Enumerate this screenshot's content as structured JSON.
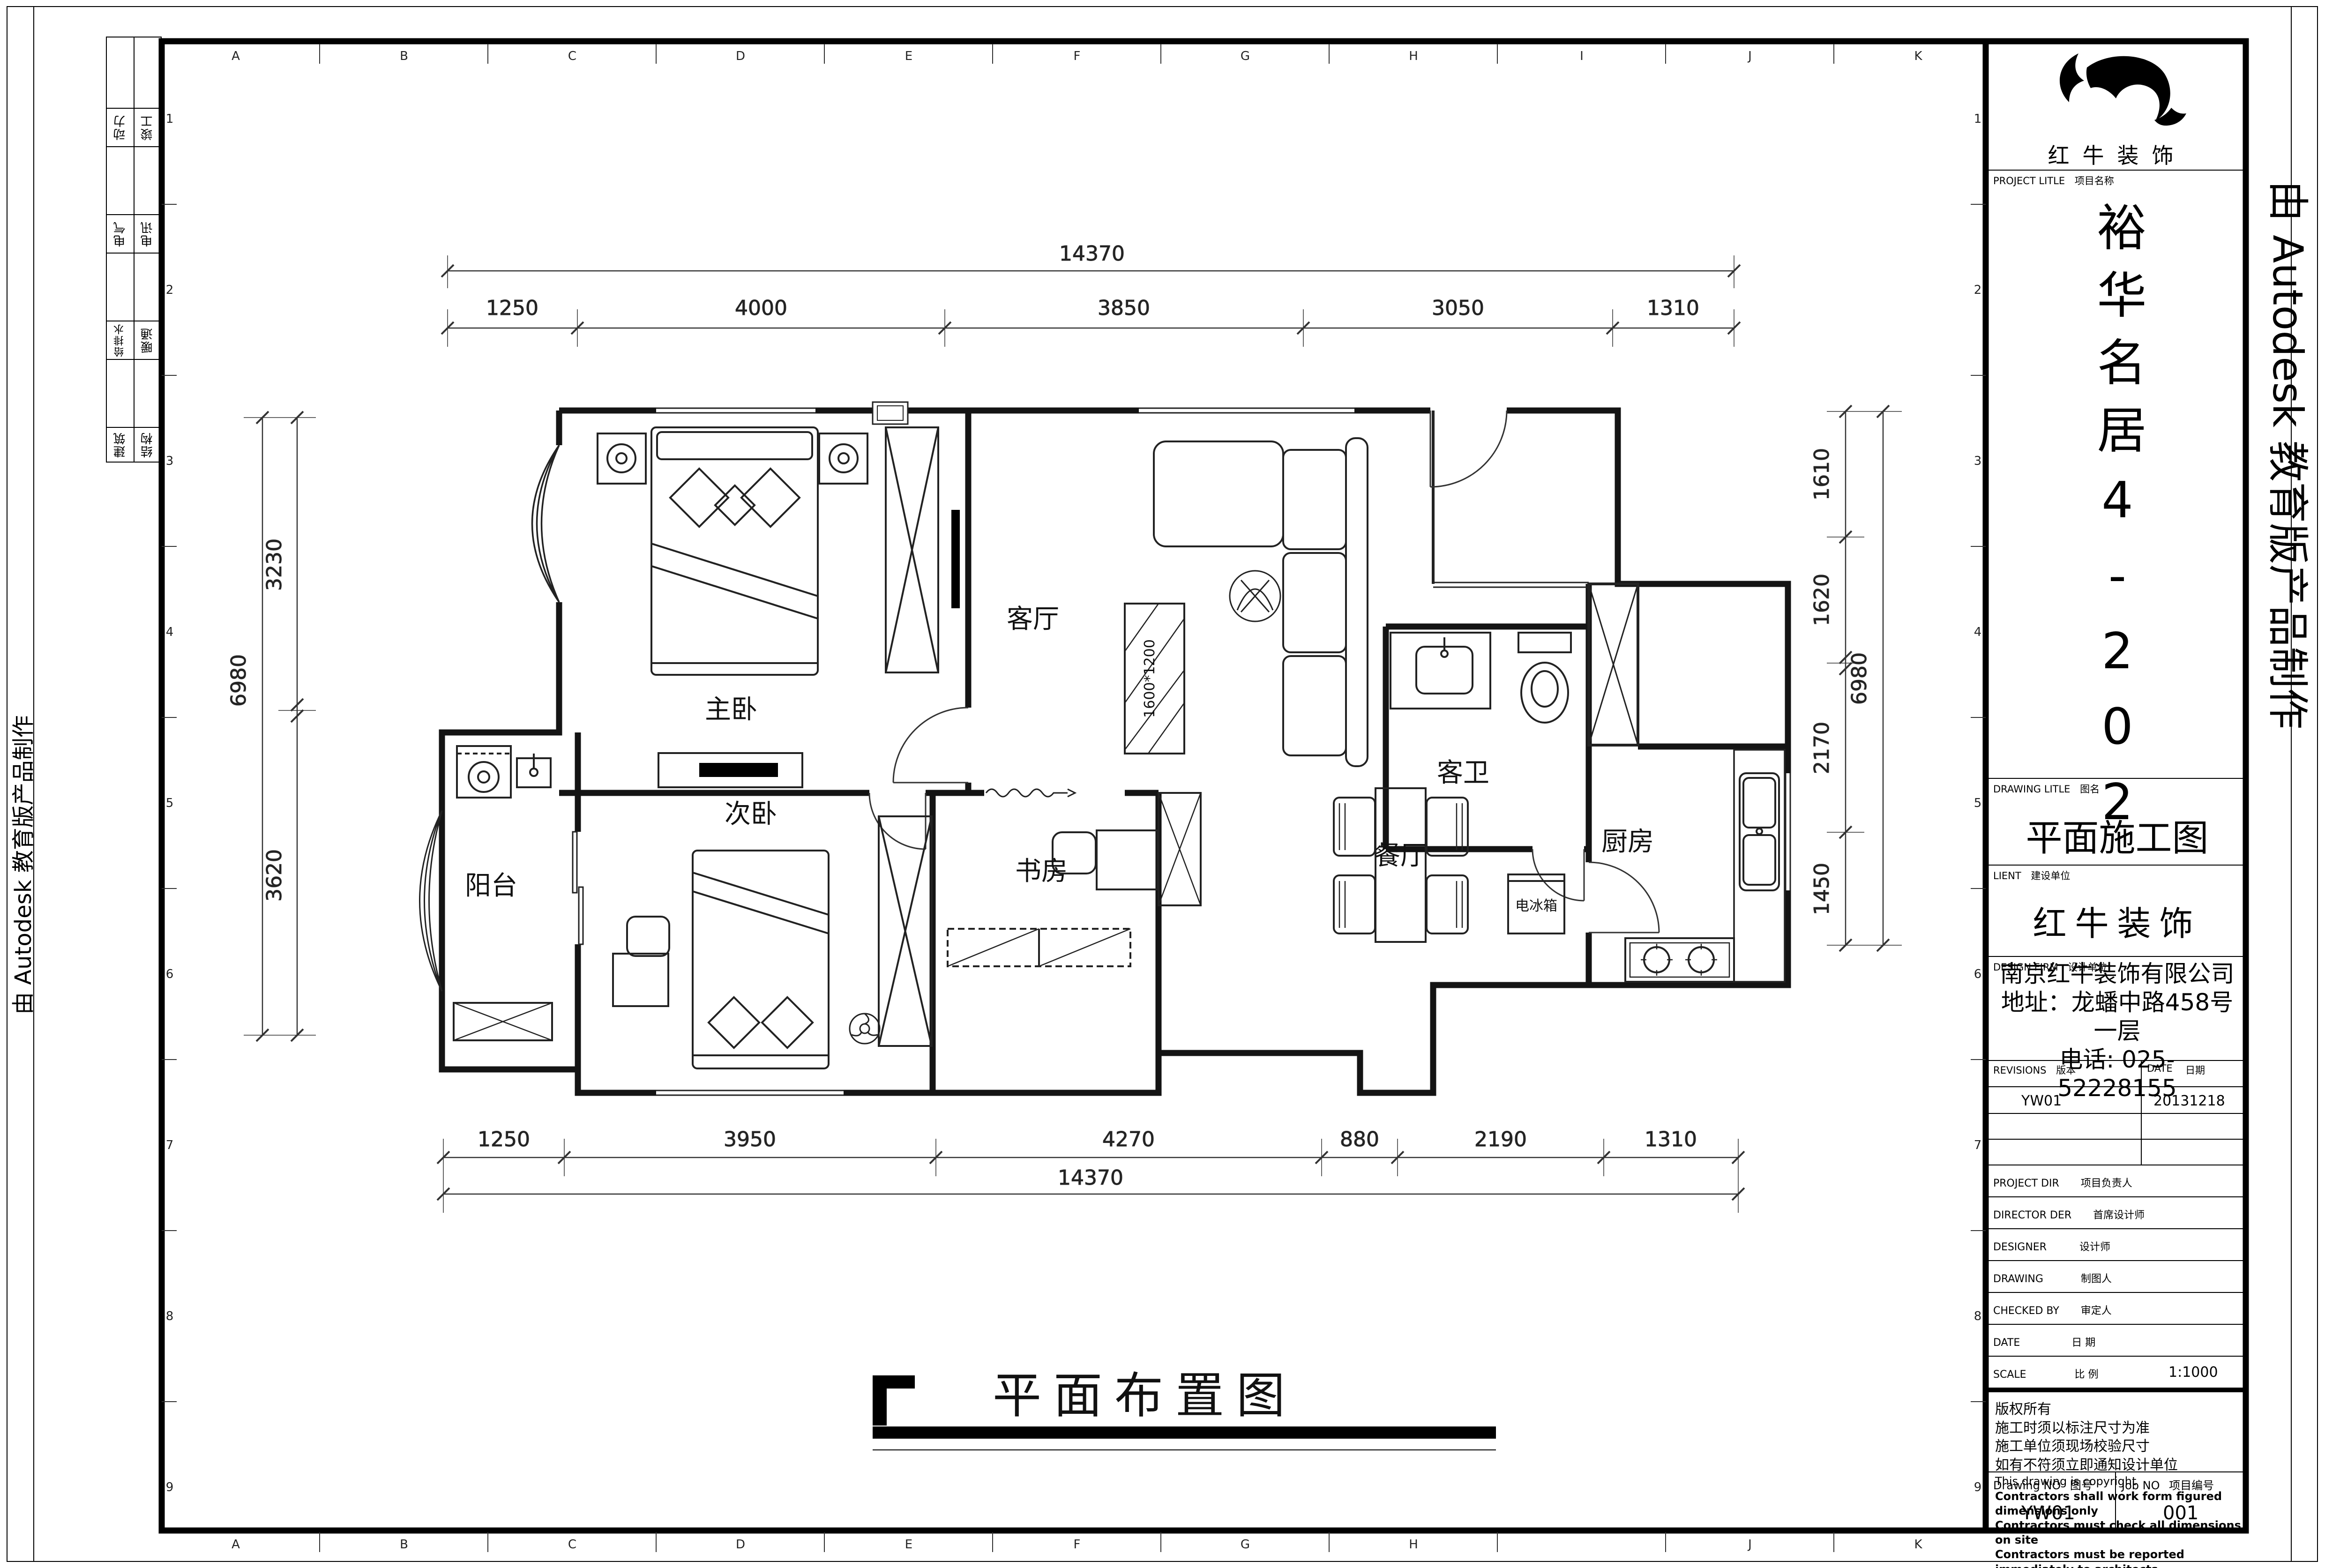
{
  "edge_note": "由 Autodesk 教育版产品制作",
  "bottom_title": "平面布置图",
  "grid": {
    "letters": [
      "A",
      "B",
      "C",
      "D",
      "E",
      "F",
      "G",
      "H",
      "I",
      "J",
      "K"
    ],
    "numbers": [
      "1",
      "2",
      "3",
      "4",
      "5",
      "6",
      "7",
      "8",
      "9"
    ]
  },
  "side_table": {
    "rows": [
      {
        "left": "动力",
        "right": "竣工"
      },
      {
        "left": "电气",
        "right": "电讯"
      },
      {
        "left": "给排水",
        "right": "暖通"
      },
      {
        "left": "建筑",
        "right": "结构"
      }
    ]
  },
  "rooms": {
    "master": "主卧",
    "second": "次卧",
    "living": "客厅",
    "bath": "客卫",
    "study": "书房",
    "dining": "餐厅",
    "kitchen": "厨房",
    "balcony": "阳台",
    "fridge": "电冰箱",
    "coffee_table_size": "1600*1200"
  },
  "dims": {
    "top_total": "14370",
    "top_chain": [
      "1250",
      "4000",
      "3850",
      "3050",
      "1310"
    ],
    "bottom_total": "14370",
    "bottom_chain": [
      "1250",
      "3950",
      "4270",
      "880",
      "2190",
      "1310"
    ],
    "left_total": "6980",
    "left_chain": [
      "3230",
      "3620"
    ],
    "right_total": "6980",
    "right_chain": [
      "1610",
      "1620",
      "2170",
      "1450"
    ]
  },
  "title_block": {
    "company": "红牛装饰",
    "project_label": "PROJECT LITLE",
    "project_label_cn": "项目名称",
    "project_name": "裕华名居4-202",
    "drawing_label": "DRAWING LITLE",
    "drawing_label_cn": "图名",
    "drawing_title": "平面施工图",
    "client_label": "LIENT",
    "client_label_cn": "建设单位",
    "client": "红牛装饰",
    "firm_label": "DESIGN FIRM",
    "firm_label_cn": "设计单位",
    "firm": "南京红牛装饰有限公司",
    "firm_address": "地址：龙蟠中路458号一层",
    "firm_phone": "电话: 025-52228155",
    "revisions_label": "REVISIONS",
    "revisions_label_cn": "版本",
    "date_label": "DATE",
    "date_label_cn": "日期",
    "revision_no": "YW01",
    "revision_date": "20131218",
    "rows": [
      {
        "en": "PROJECT DIR",
        "cn": "项目负责人"
      },
      {
        "en": "DIRECTOR DER",
        "cn": "首席设计师"
      },
      {
        "en": "DESIGNER",
        "cn": "设计师"
      },
      {
        "en": "DRAWING",
        "cn": "制图人"
      },
      {
        "en": "CHECKED BY",
        "cn": "审定人"
      },
      {
        "en": "DATE",
        "cn": "日  期"
      },
      {
        "en": "SCALE",
        "cn": "比  例"
      }
    ],
    "scale_value": "1:1000",
    "copyright_lines": [
      "版权所有",
      "施工时须以标注尺寸为准",
      "施工单位须现场校验尺寸",
      "如有不符须立即通知设计单位",
      "This drawing is copyright",
      "Contractors shall work form figured dimensions only",
      "Contractors must check all dimensions on site",
      "Contractors must be reported immediately to architects"
    ],
    "drawing_no_label": "Drawing NO",
    "drawing_no_label_cn": "图号",
    "drawing_no": "YW01",
    "job_no_label": "Job NO",
    "job_no_label_cn": "项目编号",
    "job_no": "001"
  }
}
